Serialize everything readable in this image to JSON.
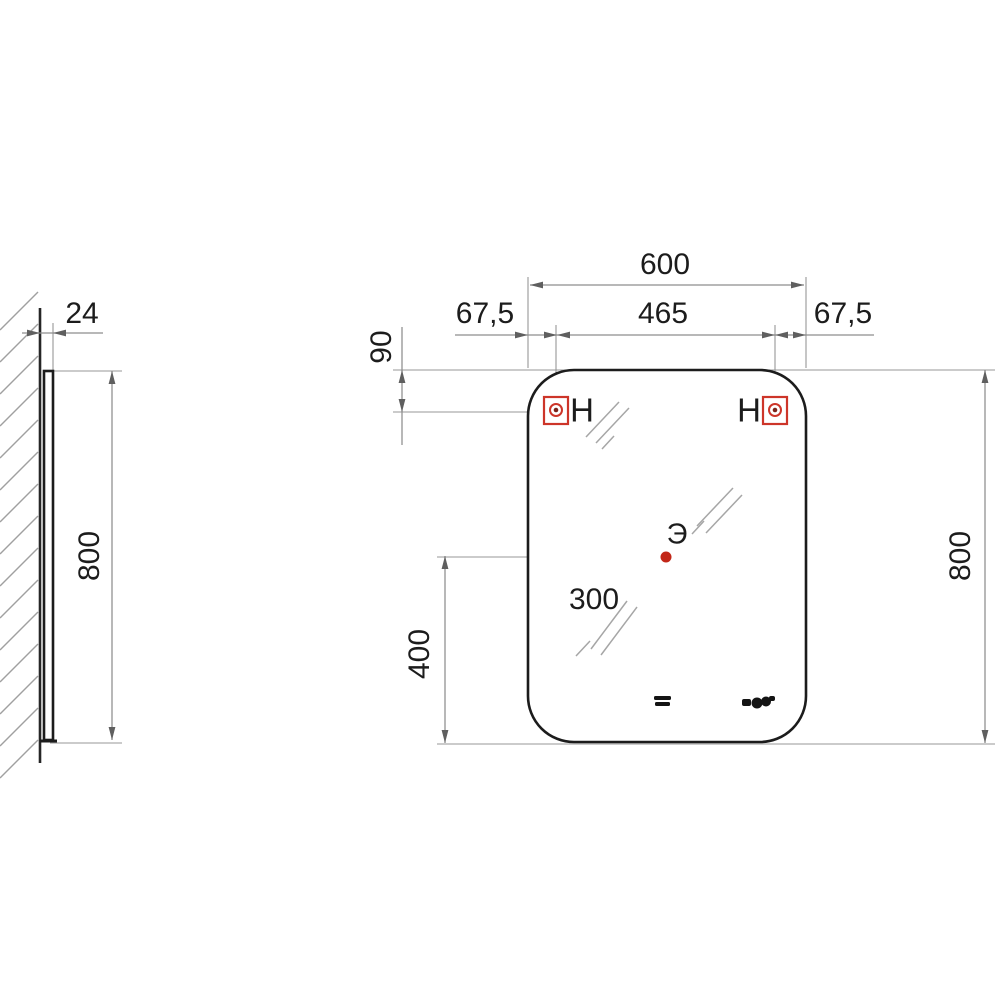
{
  "drawing": {
    "side_view": {
      "depth_mm": "24",
      "height_mm": "800"
    },
    "front_view": {
      "width_mm": "600",
      "hanger_offset_left_mm": "67,5",
      "hanger_spacing_mm": "465",
      "hanger_offset_right_mm": "67,5",
      "hanger_drop_mm": "90",
      "height_mm": "800",
      "outlet_horizontal_mm": "300",
      "outlet_vertical_mm": "400",
      "hanger_label_left": "H",
      "hanger_label_right": "H",
      "outlet_label": "Э"
    },
    "icons": {
      "hanger_bracket": "red square with mounting hole",
      "outlet_point": "red dot",
      "touch_switch": "double bar glyph",
      "display": "clock cluster glyph",
      "glass_hatch": "double diagonal strokes",
      "wall_hatch": "diagonal section hatching"
    },
    "colors": {
      "accent_red": "#cd3529",
      "outlet_dot": "#c22718",
      "outline": "#1c1c1c",
      "dim_gray": "#8e8e8e"
    }
  }
}
